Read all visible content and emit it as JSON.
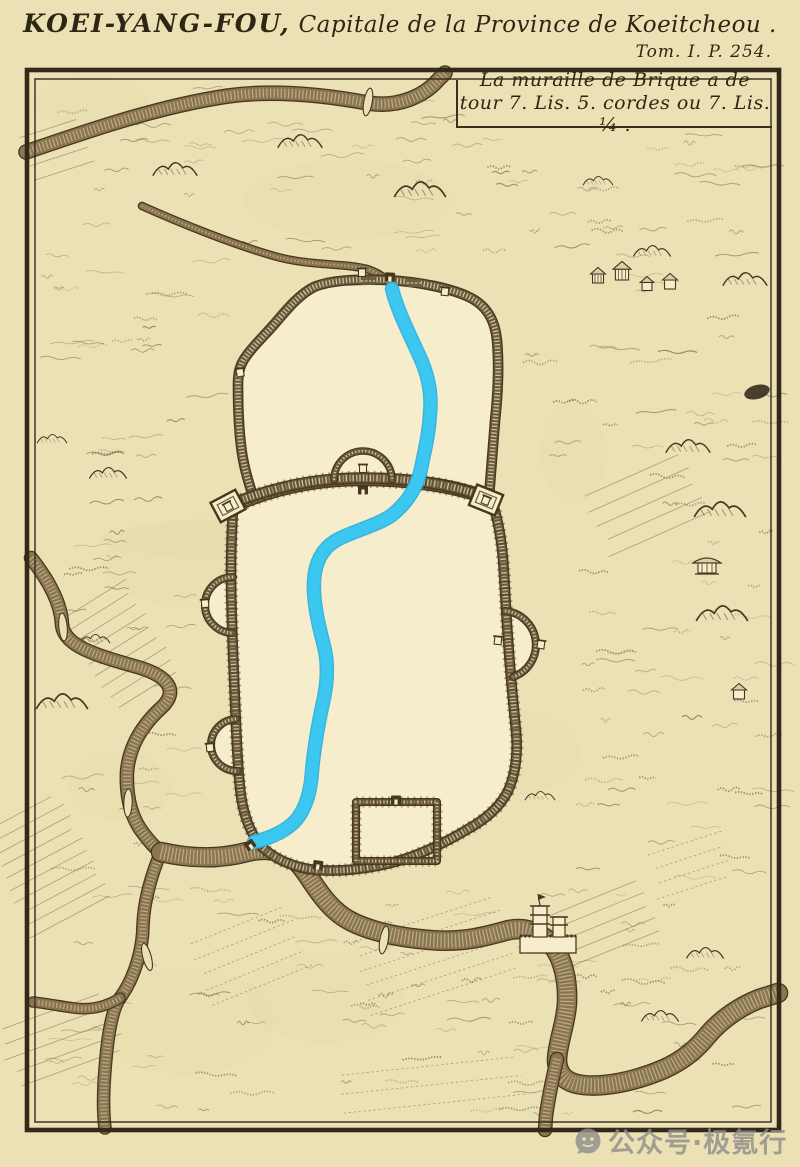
{
  "header": {
    "title_caps": "KOEI-YANG-FOU,",
    "title_rest": " Capitale de la Province de Koeitcheou .",
    "volume_ref": "Tom. I. P. 254."
  },
  "cartouche": {
    "line1": "La muraille de Brique a de",
    "line2": "tour 7. Lis. 5. cordes ou 7. Lis. ¼ ."
  },
  "watermark": {
    "text": "公众号·极氪行",
    "icon": "wechat-official-account-icon"
  },
  "map": {
    "type": "engraved-city-plan",
    "features": [
      "upper-walled-enclosure",
      "lower-walled-enclosure",
      "junction-wall-with-barbican",
      "corner-bastions",
      "side-barbicans",
      "south-outwork",
      "river-highlighted-blue",
      "sepia-rivers",
      "bridges",
      "pagoda-compound",
      "hut-cluster",
      "hill-pavilion",
      "terrain-hatching",
      "field-patches"
    ],
    "colors": {
      "paper": "#ece1b4",
      "city_interior": "#f5edcb",
      "ink_dark": "#46381f",
      "ink_mid": "#6b5b3e",
      "river_fill": "#8a7550",
      "river_highlight": "#3bc7f0",
      "frame": "#33291a",
      "watermark_gray": "#8f8f8a"
    }
  }
}
